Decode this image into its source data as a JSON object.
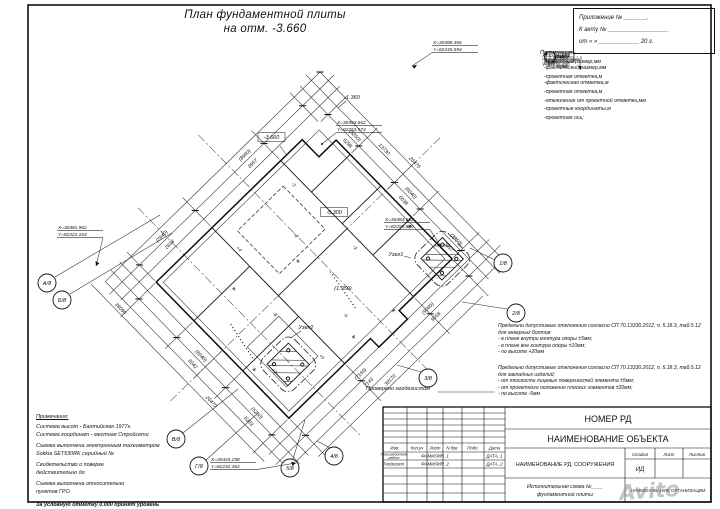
{
  "sheet": {
    "title_line1": "План фундаментной плиты",
    "title_line2": "на отм. -3.660"
  },
  "appendix": {
    "line1": "Приложение № _______.",
    "line2": "К акту № __________________",
    "line3": "от  «     »  ____________ 20     г."
  },
  "legend": {
    "header": "Примечания:",
    "dim_sym_top": "(5250)",
    "dim_sym_bottom": "5298",
    "dim_label_top": "-проектный размер,мм",
    "dim_label_bottom": "-фактический размер,мм",
    "elev_sym_top": "(-1.300)",
    "elev_sym_bottom": "-1.301",
    "elev_label_top": "-проектная отметка,м",
    "elev_label_bottom": "-фактическая отметка,м",
    "box_sym": "-5.300",
    "box_label": "-проектная отметка,м",
    "dev_sym": "+3",
    "dev_label": "-отклонение от проектной отметки,мм",
    "coord_sym_top": "Х=30483.662",
    "coord_sym_bottom": "Y=82255.890",
    "coord_label": "-проектные координаты,м",
    "axis_sym": "2",
    "axis_label": "-проектная ось;"
  },
  "tolerances": {
    "p1_line1": "Предельно допустимые отклонения согласно СП 70.13330.2012, п. 5.18.3, таб.5.12",
    "p1_line2": "для анкерных болтов:",
    "p1_items": [
      "- в плане внутри контура опоры ±5мм;",
      "- в плане вне контура опоры  ±10мм;",
      "- по высоте +20мм"
    ],
    "p2_line1": "Предельно допустимые отклонения согласно СП 70.13330.2012, п. 5.18.3, таб.5.12",
    "p2_line2": "для закладных изделий:",
    "p2_items": [
      "- от плоскости лицевых поверхностей элемента ±5мм;",
      "- от проектного положения плоских элементов  ±20мм;",
      "- по высоте -5мм"
    ],
    "checked": "Проверено геодезистом"
  },
  "notes": {
    "header": "Примечания:",
    "lines": [
      "Система высот - Балтийская 1977г.",
      "Система координат - местная Стройсети",
      "Съемка выполнена электронным тахеометром",
      "Sokkia SET530RK серийный №",
      "Свидетельство о поверке",
      "действительно до",
      "Съемка выполнена относительно",
      "пунктов ГРО"
    ],
    "footer": "За условную отметку 0.000 принят уровень ______"
  },
  "titleblock": {
    "doc_number": "НОМЕР РД",
    "object_name": "НАИМЕНОВАНИЕ ОБЪЕКТА",
    "rd_name": "НАИМЕНОВАНИЕ РД, СООРУЖЕНИЯ",
    "cols": [
      "Изм.",
      "Кол.уч",
      "Лист",
      "N док.",
      "Подп.",
      "Дата"
    ],
    "row1_role": "Производитель",
    "row1_role2": "работ",
    "row1_name": "ФАМИЛИЯ_1",
    "row1_date": "ДАТА_1",
    "row2_role": "Геодезист",
    "row2_name": "ФАМИЛИЯ_2",
    "row2_date": "ДАТА_2",
    "stage": "Стадия",
    "sheet": "Лист",
    "sheets": "Листов",
    "stage_value": "ИД",
    "scheme_line1": "Исполнительная схема №____",
    "scheme_line2": "фундаментной плиты",
    "org": "НАИМЕНОВАНИЕ ОРГАНИЗАЦИИ",
    "watermark": "Avito"
  },
  "plan": {
    "axes": [
      {
        "label": "А/8"
      },
      {
        "label": "Б/8"
      },
      {
        "label": "В/8"
      },
      {
        "label": "Г/8"
      },
      {
        "label": "5/8"
      },
      {
        "label": "4/8"
      },
      {
        "label": "3/8"
      },
      {
        "label": "2/8"
      },
      {
        "label": "1/8"
      }
    ],
    "coords": [
      {
        "x": "Х=30498.366",
        "y": "Y=82245.594"
      },
      {
        "x": "Х=30493.662",
        "y": "Y=82253.574"
      },
      {
        "x": "Х=30481.962",
        "y": "Y=82222.164"
      },
      {
        "x": "Х=30483.662",
        "y": "Y=82255.890"
      },
      {
        "x": "Х=30443.258",
        "y": "Y=82232.462"
      }
    ],
    "labels": {
      "elev_main": "-3.660",
      "elev_box2": "-5.300",
      "elev_step": "-1.360",
      "elev_pit": "(1.950)",
      "node1": "Узел1",
      "node2": "Узел2"
    },
    "dims": [
      "26470",
      "13730",
      "(5250)",
      "5298",
      "(6040)",
      "6038",
      "(3860)",
      "3857",
      "(8960)",
      "8957",
      "(2640)",
      "2638",
      "(9060)",
      "9058",
      "(7140)",
      "7143",
      "39170",
      "(5250)",
      "5303",
      "(6040)",
      "6042",
      "38090",
      "26470"
    ],
    "deviations": [
      "-3",
      "+2",
      "-5",
      "+4",
      "-8",
      "+2",
      "-3",
      "+5"
    ],
    "survey_marker": "*"
  }
}
